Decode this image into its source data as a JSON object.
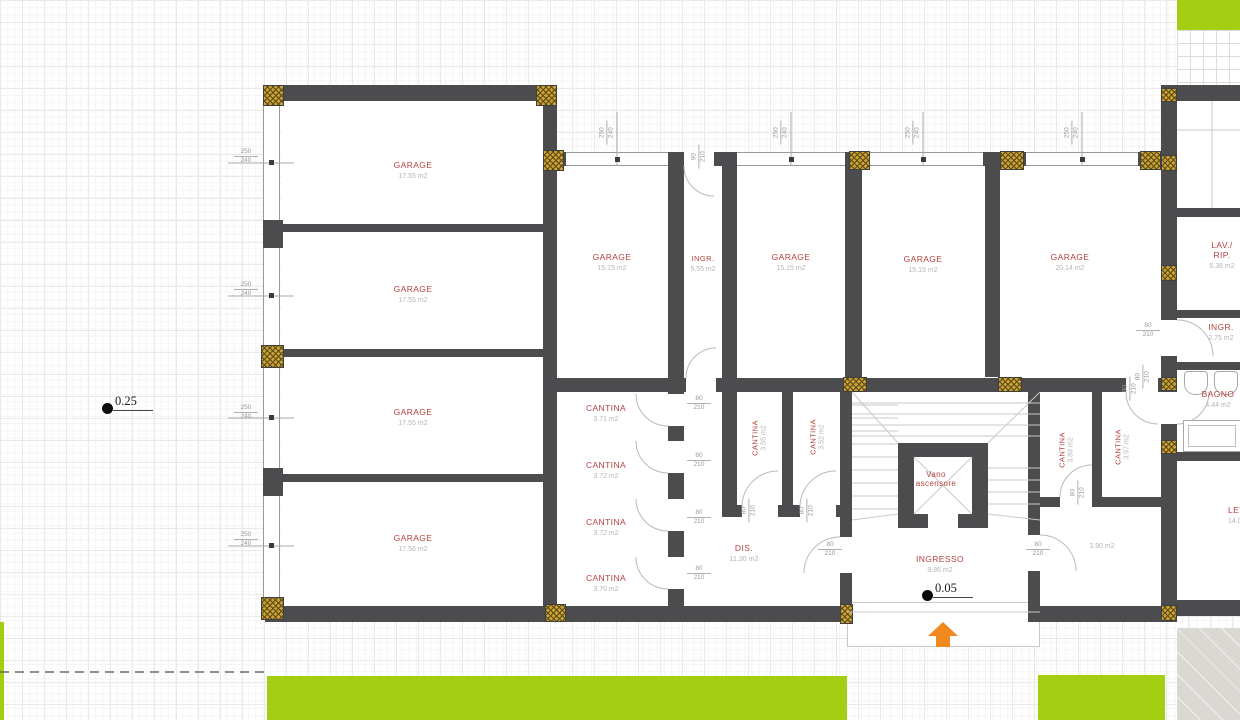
{
  "colors": {
    "wall": "#4c4c4e",
    "room_label_red": "#b2423e",
    "area_gray": "#b5b5b5",
    "green": "#a4ce12",
    "orange_arrow": "#f08a1e",
    "hatch_gold": "#c8a137"
  },
  "levels": {
    "outdoor": "0.25",
    "entrance": "0.05"
  },
  "dims": {
    "garage_w": "250",
    "garage_h": "240",
    "door_w": "80",
    "door_h": "210",
    "entry_w": "90",
    "entry_h": "210"
  },
  "rooms": {
    "garage_l1": {
      "name": "GARAGE",
      "area": "17.55 m2"
    },
    "garage_l2": {
      "name": "GARAGE",
      "area": "17.55 m2"
    },
    "garage_l3": {
      "name": "GARAGE",
      "area": "17.55 m2"
    },
    "garage_l4": {
      "name": "GARAGE",
      "area": "17.56 m2"
    },
    "garage_c1": {
      "name": "GARAGE",
      "area": "15.15 m2"
    },
    "ingr_top": {
      "name": "INGR.",
      "area": "5.55 m2"
    },
    "garage_c2": {
      "name": "GARAGE",
      "area": "15.15 m2"
    },
    "garage_c3": {
      "name": "GARAGE",
      "area": "15.15 m2"
    },
    "garage_c4": {
      "name": "GARAGE",
      "area": "20.14 m2"
    },
    "cantina_1": {
      "name": "CANTINA",
      "area": "3.71 m2"
    },
    "cantina_2": {
      "name": "CANTINA",
      "area": "3.72 m2"
    },
    "cantina_3": {
      "name": "CANTINA",
      "area": "3.72 m2"
    },
    "cantina_4": {
      "name": "CANTINA",
      "area": "3.70 m2"
    },
    "cantina_5": {
      "name": "CANTINA",
      "area": "3.55 m2"
    },
    "cantina_6": {
      "name": "CANTINA",
      "area": "3.52 m2"
    },
    "cantina_7": {
      "name": "CANTINA",
      "area": "3.89 m2"
    },
    "cantina_8": {
      "name": "CANTINA",
      "area": "3.97 m2"
    },
    "dis": {
      "name": "DIS.",
      "area": "11.30 m2"
    },
    "ingresso": {
      "name": "INGRESSO",
      "area": "9.86 m2"
    },
    "store_390": {
      "area": "3.90 m2"
    },
    "vano_ascensore": {
      "line1": "Vano",
      "line2": "ascensore"
    },
    "lav_rip": {
      "name1": "LAV./",
      "name2": "RIP.",
      "area": "5.38 m2"
    },
    "ingr_right": {
      "name": "INGR.",
      "area": "2.75 m2"
    },
    "bagno": {
      "name": "BAGNO",
      "area": "4.44 m2"
    },
    "letto": {
      "name": "LETTO",
      "area": "14.07 m2"
    }
  }
}
